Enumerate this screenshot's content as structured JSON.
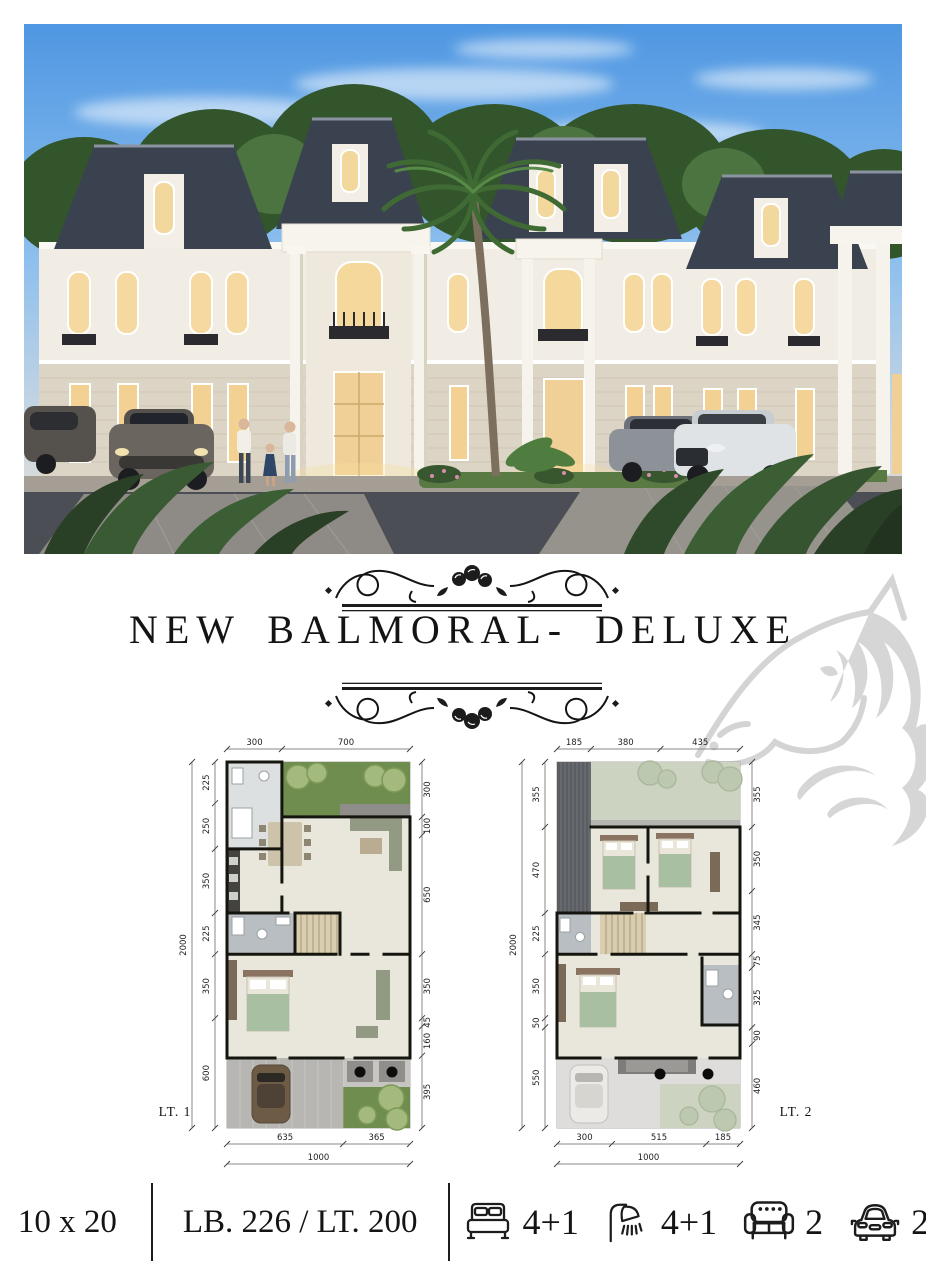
{
  "title": {
    "text": "NEW BALMORAL- DELUXE"
  },
  "watermark": {
    "name": "horse-watermark",
    "color": "#d6d6d6"
  },
  "plans": {
    "p1": {
      "label": "LT. 1",
      "top": [
        "300",
        "700"
      ],
      "left": [
        "225",
        "250",
        "350",
        "225",
        "350",
        "600"
      ],
      "left_total": "2000",
      "right": [
        "300",
        "100",
        "650",
        "350",
        "45",
        "160",
        "395"
      ],
      "bottom": [
        "635",
        "365"
      ],
      "bottom_total": "1000"
    },
    "p2": {
      "label": "LT. 2",
      "top": [
        "185",
        "380",
        "435"
      ],
      "left": [
        "355",
        "470",
        "225",
        "350",
        "50",
        "550"
      ],
      "left_total": "2000",
      "right": [
        "355",
        "350",
        "345",
        "75",
        "325",
        "90",
        "460"
      ],
      "bottom": [
        "300",
        "515",
        "185"
      ],
      "bottom_total": "1000"
    }
  },
  "specs": {
    "size": "10 x 20",
    "area": "LB. 226 / LT. 200",
    "beds": "4+1",
    "baths": "4+1",
    "sofas": "2",
    "cars": "2"
  },
  "icons": [
    "bed-icon",
    "shower-icon",
    "sofa-icon",
    "car-icon"
  ],
  "colors": {
    "ink": "#141414",
    "garden_green": "#6f8d4e",
    "pale_green": "#ccd3c1",
    "floor_beige": "#e9e6dc",
    "roof_dark": "#3a4250",
    "watermark_gray": "#d6d6d6"
  }
}
